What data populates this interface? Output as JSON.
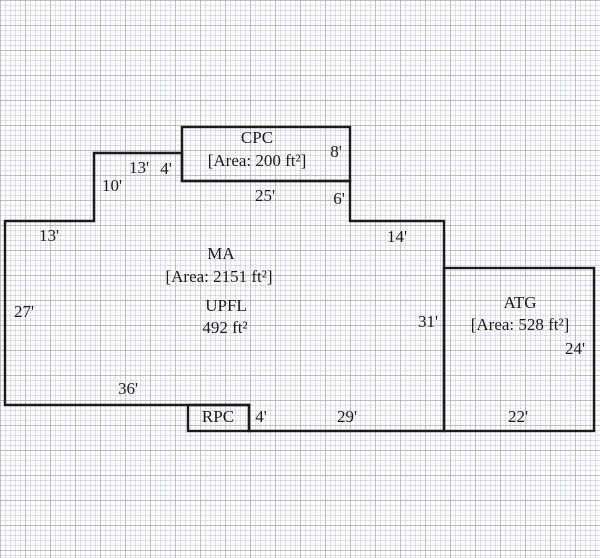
{
  "plan": {
    "rooms": {
      "cpc": {
        "name": "CPC",
        "area": "[Area: 200 ft²]"
      },
      "ma": {
        "name": "MA",
        "area": "[Area: 2151 ft²]"
      },
      "upfl": {
        "name": "UPFL",
        "area": "492 ft²"
      },
      "atg": {
        "name": "ATG",
        "area": "[Area: 528 ft²]"
      },
      "rpc": {
        "name": "RPC"
      }
    },
    "dimensions": {
      "d13_left": "13'",
      "d27_left": "27'",
      "d10_step": "10'",
      "d13_top": "13'",
      "d4_cpc_left": "4'",
      "d25_cpc_bottom": "25'",
      "d8_cpc_right": "8'",
      "d6_below_cpc": "6'",
      "d14_mid": "14'",
      "d31_ma_right": "31'",
      "d36_ma_bottom": "36'",
      "d4_rpc_right": "4'",
      "d29_bottom_mid": "29'",
      "d22_atg_bottom": "22'",
      "d24_atg_right": "24'"
    },
    "colors": {
      "wall": "#1b1b1b",
      "paper": "#fdfdfd",
      "grid_minor": "#d9d9e6",
      "grid_major": "#c6c0b8"
    }
  }
}
